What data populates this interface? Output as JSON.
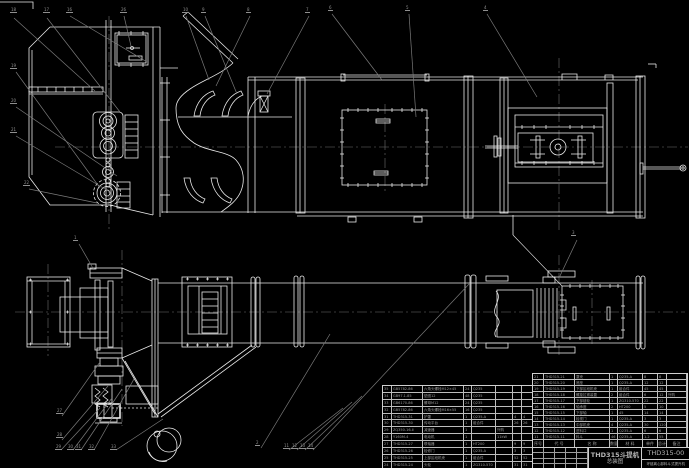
{
  "colors": {
    "background": "#000000",
    "line": "#e9e9e9",
    "leader": "#7a7a7a",
    "centerline": "#6e6e6e",
    "table_text": "#9c9c9c",
    "logo_dark": "#26262a"
  },
  "title_block": {
    "product": "THD315斗提机",
    "sheet_type": "总装图",
    "drawing_no": "THD315-00",
    "subtitle": "环链离心卸料斗式提升机"
  },
  "bom_right": {
    "header": [
      "序号",
      "代 号",
      "名 称",
      "数量",
      "材 料",
      "单件",
      "总计",
      "备注"
    ],
    "rows": [
      {
        "seq": "21",
        "code": "THD315-21",
        "name": "罩壳",
        "qty": "1",
        "material": "Q235-A",
        "unit": "8",
        "total": "8",
        "remark": ""
      },
      {
        "seq": "20",
        "code": "THD315-20",
        "name": "底座",
        "qty": "1",
        "material": "Q235-A",
        "unit": "12",
        "total": "12",
        "remark": ""
      },
      {
        "seq": "19",
        "code": "THD315-19",
        "name": "下部区段机壳",
        "qty": "1",
        "material": "组合件",
        "unit": "45",
        "total": "45",
        "remark": ""
      },
      {
        "seq": "18",
        "code": "THD315-18",
        "name": "螺旋拉紧装置",
        "qty": "2",
        "material": "组合件",
        "unit": "6",
        "total": "12",
        "remark": "外购"
      },
      {
        "seq": "17",
        "code": "THD315-17",
        "name": "下部链轮",
        "qty": "1",
        "material": "ZG310-570",
        "unit": "22",
        "total": "22",
        "remark": ""
      },
      {
        "seq": "16",
        "code": "THD315-16",
        "name": "轴承座",
        "qty": "2",
        "material": "HT200",
        "unit": "5",
        "total": "10",
        "remark": ""
      },
      {
        "seq": "15",
        "code": "THD315-15",
        "name": "下部轴",
        "qty": "1",
        "material": "45",
        "unit": "14",
        "total": "14",
        "remark": ""
      },
      {
        "seq": "14",
        "code": "THD315-14",
        "name": "检视门",
        "qty": "1",
        "material": "Q235-A",
        "unit": "3",
        "total": "3",
        "remark": ""
      },
      {
        "seq": "13",
        "code": "THD315-13",
        "name": "中部机壳",
        "qty": "4",
        "material": "Q235-A",
        "unit": "30",
        "total": "120",
        "remark": ""
      },
      {
        "seq": "12",
        "code": "THD315-12",
        "name": "进料口",
        "qty": "1",
        "material": "Q235-A",
        "unit": "6",
        "total": "6",
        "remark": ""
      },
      {
        "seq": "11",
        "code": "THD315-11",
        "name": "料斗",
        "qty": "46",
        "material": "Q235-A",
        "unit": "1.2",
        "total": "55",
        "remark": ""
      }
    ]
  },
  "bom_left": {
    "rows": [
      {
        "seq": "35",
        "code": "GB5782-86",
        "name": "六角头螺栓M12×45",
        "qty": "24",
        "material": "Q235",
        "remark": "",
        "unit": "",
        "total": ""
      },
      {
        "seq": "34",
        "code": "GB97.1-85",
        "name": "垫圈12",
        "qty": "48",
        "material": "Q235",
        "remark": "",
        "unit": "",
        "total": ""
      },
      {
        "seq": "33",
        "code": "GB6170-86",
        "name": "螺母M12",
        "qty": "24",
        "material": "Q235",
        "remark": "",
        "unit": "",
        "total": ""
      },
      {
        "seq": "32",
        "code": "GB5782-86",
        "name": "六角头螺栓M16×55",
        "qty": "16",
        "material": "Q235",
        "remark": "",
        "unit": "",
        "total": ""
      },
      {
        "seq": "31",
        "code": "THD315-31",
        "name": "护罩",
        "qty": "1",
        "material": "Q235-A",
        "remark": "",
        "unit": "4",
        "total": "4"
      },
      {
        "seq": "30",
        "code": "THD315-30",
        "name": "传动平台",
        "qty": "1",
        "material": "组合件",
        "remark": "",
        "unit": "26",
        "total": "26"
      },
      {
        "seq": "29",
        "code": "ZQ350-16-Ⅱ",
        "name": "减速器",
        "qty": "1",
        "material": "",
        "remark": "外购",
        "unit": "",
        "total": ""
      },
      {
        "seq": "28",
        "code": "Y160M-4",
        "name": "电动机",
        "qty": "1",
        "material": "",
        "remark": "11kW",
        "unit": "",
        "total": ""
      },
      {
        "seq": "27",
        "code": "THD315-27",
        "name": "联轴器",
        "qty": "1",
        "material": "HT200",
        "remark": "",
        "unit": "9",
        "total": "9"
      },
      {
        "seq": "26",
        "code": "THD315-26",
        "name": "检修门",
        "qty": "1",
        "material": "Q235-A",
        "remark": "",
        "unit": "3",
        "total": "3"
      },
      {
        "seq": "25",
        "code": "THD315-25",
        "name": "上部区段机壳",
        "qty": "1",
        "material": "组合件",
        "remark": "",
        "unit": "52",
        "total": "52"
      },
      {
        "seq": "24",
        "code": "THD315-24",
        "name": "头轮",
        "qty": "1",
        "material": "ZG310-570",
        "remark": "",
        "unit": "31",
        "total": "31"
      }
    ]
  },
  "balloons": [
    {
      "x": 10,
      "y": 8,
      "label": "18"
    },
    {
      "x": 43,
      "y": 8,
      "label": "17"
    },
    {
      "x": 66,
      "y": 8,
      "label": "16"
    },
    {
      "x": 120,
      "y": 8,
      "label": "26"
    },
    {
      "x": 182,
      "y": 8,
      "label": "10"
    },
    {
      "x": 201,
      "y": 8,
      "label": "9"
    },
    {
      "x": 246,
      "y": 8,
      "label": "8"
    },
    {
      "x": 305,
      "y": 8,
      "label": "7"
    },
    {
      "x": 328,
      "y": 6,
      "label": "6"
    },
    {
      "x": 405,
      "y": 6,
      "label": "5"
    },
    {
      "x": 483,
      "y": 6,
      "label": "4"
    },
    {
      "x": 10,
      "y": 64,
      "label": "19"
    },
    {
      "x": 10,
      "y": 99,
      "label": "20"
    },
    {
      "x": 10,
      "y": 128,
      "label": "21"
    },
    {
      "x": 23,
      "y": 181,
      "label": "22"
    },
    {
      "x": 73,
      "y": 236,
      "label": "1"
    },
    {
      "x": 56,
      "y": 409,
      "label": "27"
    },
    {
      "x": 56,
      "y": 433,
      "label": "28"
    },
    {
      "x": 55,
      "y": 445,
      "label": "29"
    },
    {
      "x": 67,
      "y": 445,
      "label": "30"
    },
    {
      "x": 75,
      "y": 445,
      "label": "31"
    },
    {
      "x": 88,
      "y": 445,
      "label": "32"
    },
    {
      "x": 110,
      "y": 445,
      "label": "33"
    },
    {
      "x": 255,
      "y": 441,
      "label": "2"
    },
    {
      "x": 283,
      "y": 444,
      "label": "11"
    },
    {
      "x": 291,
      "y": 444,
      "label": "12"
    },
    {
      "x": 299,
      "y": 444,
      "label": "13"
    },
    {
      "x": 307,
      "y": 444,
      "label": "14"
    },
    {
      "x": 571,
      "y": 231,
      "label": "3"
    }
  ]
}
